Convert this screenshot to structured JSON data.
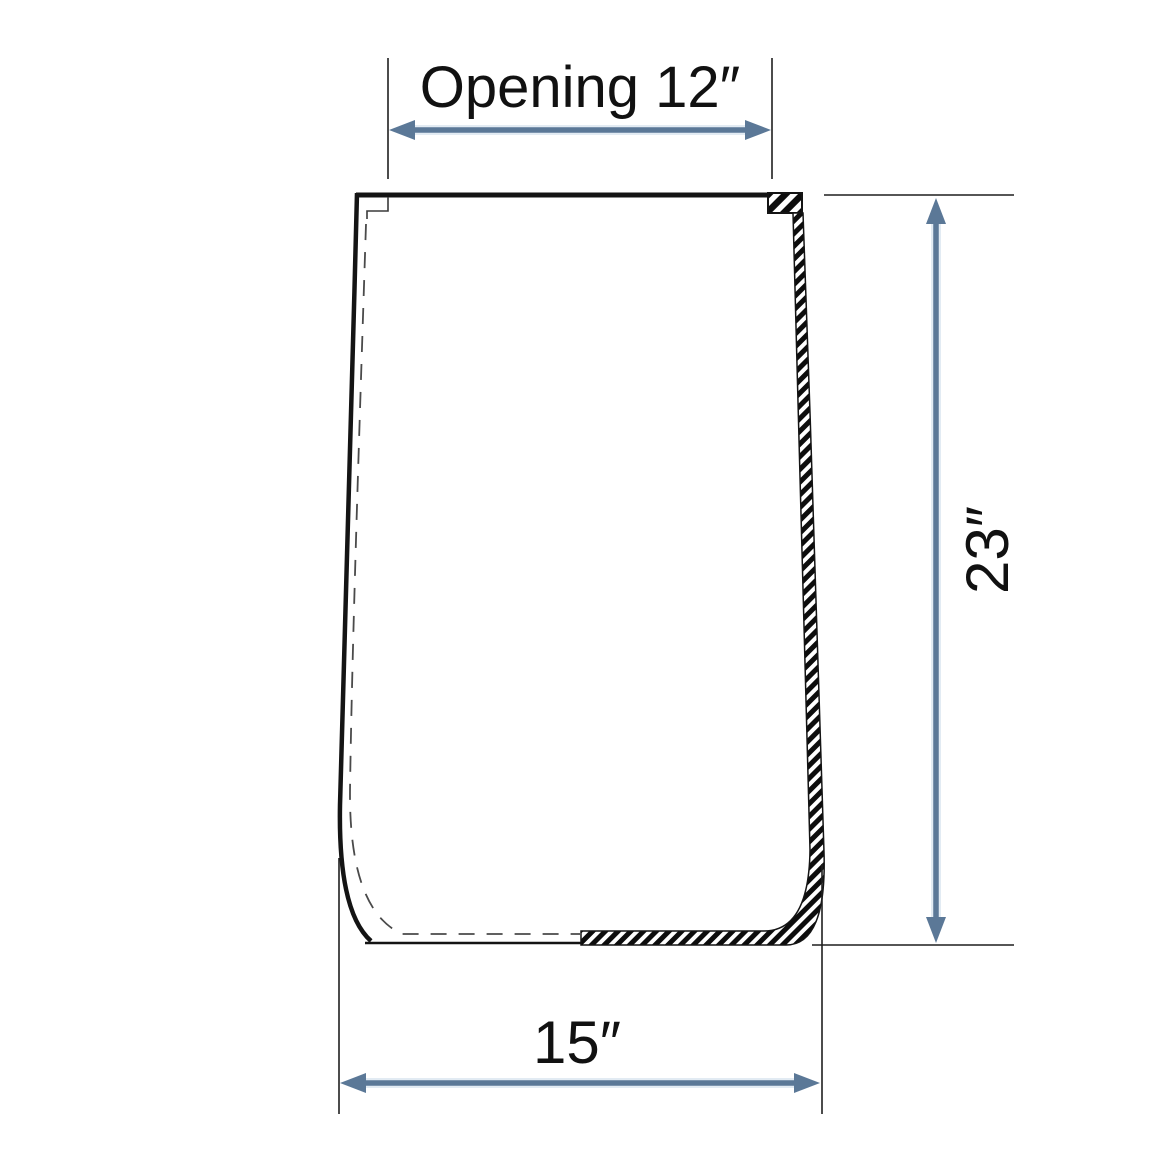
{
  "diagram": {
    "labels": {
      "opening": "Opening 12″",
      "height": "23″",
      "width": "15″"
    },
    "dimensions_inches": {
      "opening": 12,
      "height": 23,
      "width": 15
    },
    "colors": {
      "arrow": "#5b7897",
      "arrow_halo": "#dde8f2",
      "outline": "#141414",
      "hidden_line": "#4a4a4a"
    }
  }
}
